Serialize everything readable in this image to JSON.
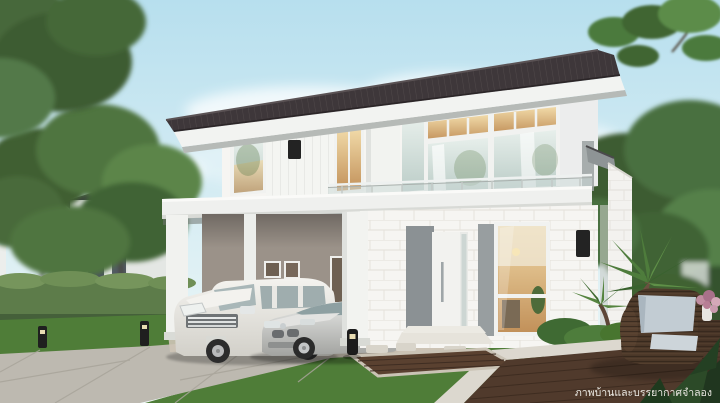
{
  "caption": {
    "text": "ภาพบ้านและบรรยากาศจำลอง"
  },
  "scene": {
    "description": "3D architectural rendering: modern two-storey detached house with dark tiled roof, white walls, glass balcony, carport with white minivan and silver sedan, landscaped garden, timber decks and a rattan armchair",
    "objects": [
      "sky",
      "clouds",
      "trees",
      "neighbor-house",
      "hedge",
      "lawn",
      "driveway",
      "house",
      "roof",
      "balcony-railing",
      "carport",
      "minivan",
      "sedan",
      "entrance-door",
      "living-window",
      "palm-tree",
      "bollard-lights",
      "timber-deck",
      "rattan-armchair",
      "cushion",
      "flower-vase",
      "caption"
    ]
  },
  "palette": {
    "sky_top": "#b7dfee",
    "sky_bottom": "#eff7f6",
    "roof_tile": "#3e373a",
    "fascia_white": "#f2f3f1",
    "wall_white": "#f6f5f2",
    "carport_wall": "#9b9289",
    "accent_gray": "#959b9d",
    "glass": "#cfdcd8",
    "warm_light": "#e3bc82",
    "grass": "#4f7d38",
    "hedge": "#5d7c4a",
    "tree_dark": "#3c5a33",
    "tree_light": "#6f9150",
    "concrete": "#bdb9b0",
    "deck_wood": "#503a2c",
    "rattan": "#4a3728",
    "cushion": "#c2ccd3",
    "fixture_black": "#232323",
    "car_white": "#ecebe7",
    "car_silver": "#c6c6c4",
    "caption_text": "#eae8e2"
  }
}
